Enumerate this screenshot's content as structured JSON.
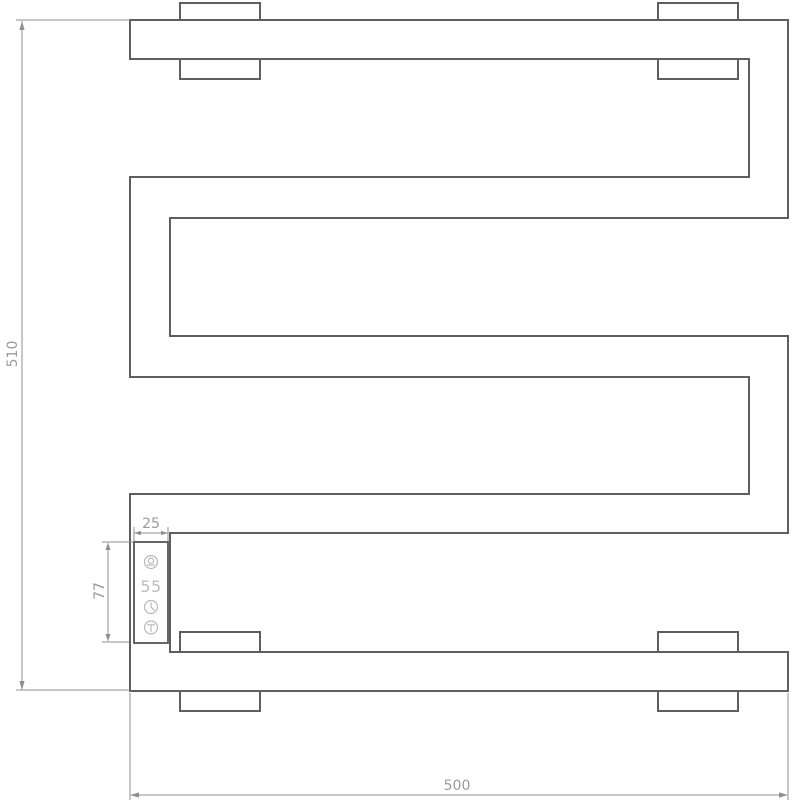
{
  "drawing": {
    "name": "heated-towel-rail-technical-drawing",
    "dimensions": {
      "overall_height": "510",
      "overall_width": "500",
      "controller_width": "25",
      "controller_height": "77"
    },
    "controller": {
      "display_value": "55",
      "icons": [
        {
          "name": "power-mode-icon"
        },
        {
          "name": "timer-clock-icon"
        },
        {
          "name": "temperature-icon"
        }
      ]
    },
    "colors": {
      "background": "#ffffff",
      "outline": "#5f5f5f",
      "dimension_line": "#8f8f8f",
      "dimension_text": "#9a9a9a",
      "controller_glyphs": "#b9b9b9"
    }
  }
}
